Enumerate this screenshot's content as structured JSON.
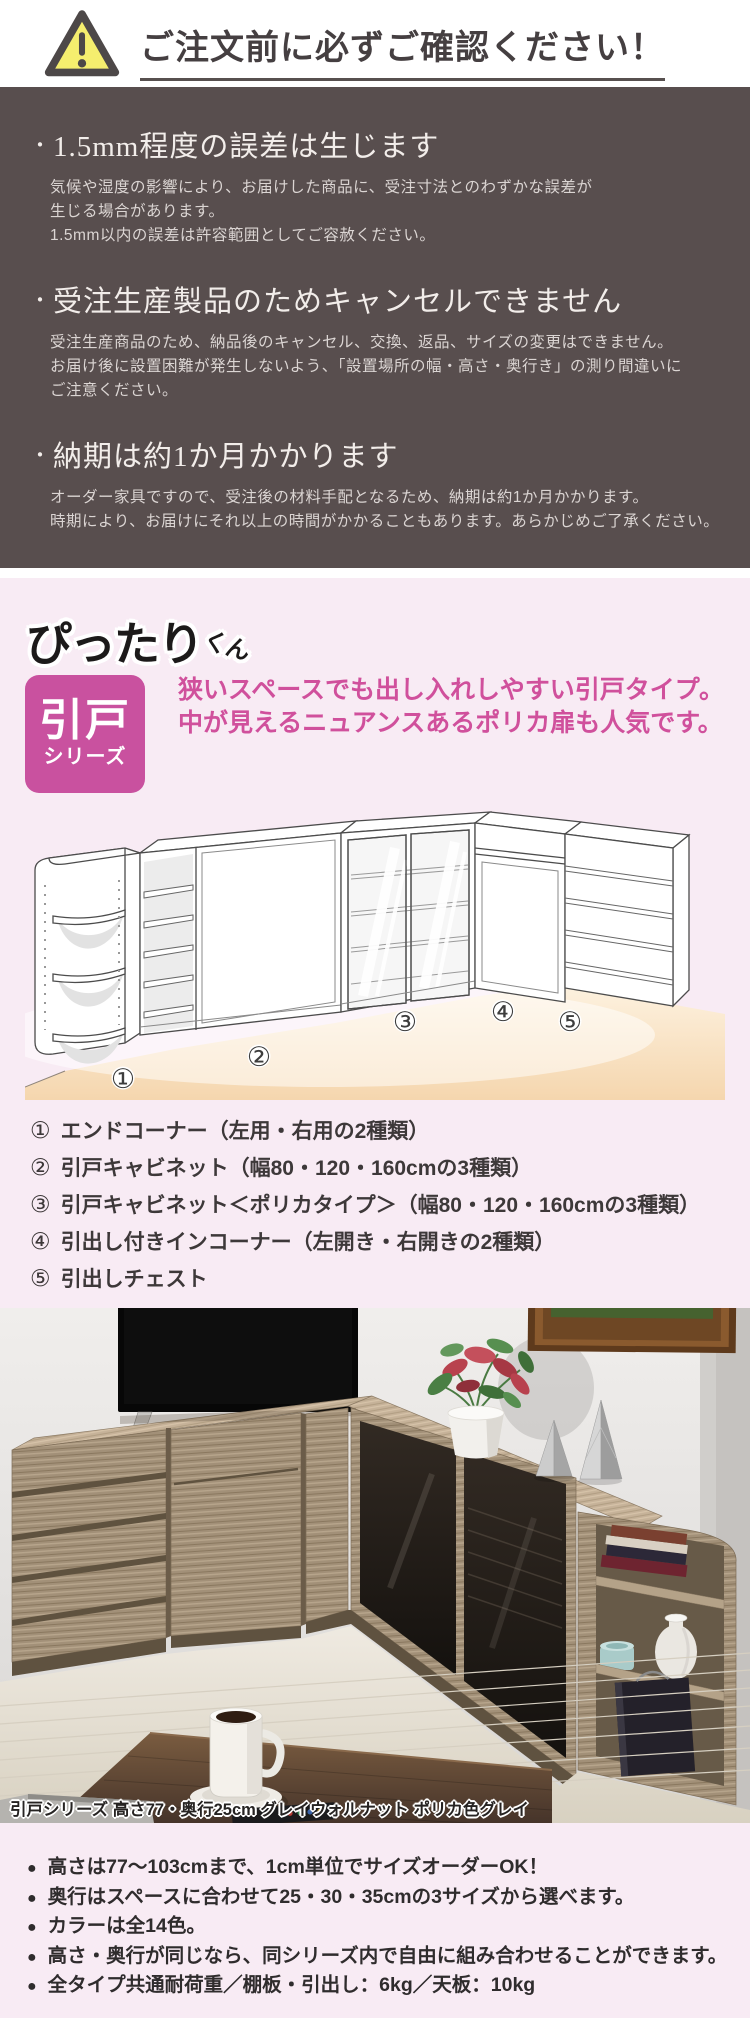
{
  "notice_header": {
    "icon": "warning-triangle-icon",
    "title": "ご注文前に必ずご確認ください！"
  },
  "order_notes": {
    "marker": "・",
    "items": [
      {
        "heading": "1.5mm程度の誤差は生じます",
        "lines": [
          "気候や湿度の影響により、お届けした商品に、受注寸法とのわずかな誤差が",
          "生じる場合があります。",
          "1.5mm以内の誤差は許容範囲としてご容赦ください。"
        ]
      },
      {
        "heading": "受注生産製品のためキャンセルできません",
        "lines": [
          "受注生産商品のため、納品後のキャンセル、交換、返品、サイズの変更はできません。",
          "お届け後に設置困難が発生しないよう、「設置場所の幅・高さ・奥行き」の測り間違いに",
          "ご注意ください。"
        ]
      },
      {
        "heading": "納期は約1か月かかります",
        "lines": [
          "オーダー家具ですので、受注後の材料手配となるため、納期は約1か月かかります。",
          "時期により、お届けにそれ以上の時間がかかることもあります。あらかじめご了承ください。"
        ]
      }
    ]
  },
  "series": {
    "logo_main": "ぴったり",
    "logo_suffix": "くん",
    "badge_line1": "引戸",
    "badge_line2": "シリーズ",
    "description_lines": [
      "狭いスペースでも出し入れしやすい引戸タイプ。",
      "中が見えるニュアンスあるポリカ扉も人気です。"
    ],
    "diagram_numbers": [
      "①",
      "②",
      "③",
      "④",
      "⑤"
    ],
    "legend": [
      {
        "num": "①",
        "text": "エンドコーナー（左用・右用の2種類）"
      },
      {
        "num": "②",
        "text": "引戸キャビネット（幅80・120・160cmの3種類）"
      },
      {
        "num": "③",
        "text": "引戸キャビネット＜ポリカタイプ＞（幅80・120・160cmの3種類）"
      },
      {
        "num": "④",
        "text": "引出し付きインコーナー（左開き・右開きの2種類）"
      },
      {
        "num": "⑤",
        "text": "引出しチェスト"
      }
    ]
  },
  "photo": {
    "caption": "引戸シリーズ 高さ77・奥行25cm グレイウォルナット ポリカ色グレイ"
  },
  "features": {
    "bullet": "●",
    "items": [
      "高さは77〜103cmまで、1cm単位でサイズオーダーOK！",
      "奥行はスペースに合わせて25・30・35cmの3サイズから選べます。",
      "カラーは全14色。",
      "高さ・奥行が同じなら、同シリーズ内で自由に組み合わせることができます。",
      "全タイプ共通耐荷重／棚板・引出し：6kg／天板：10kg"
    ]
  },
  "colors": {
    "dark_section_bg": "#584e4e",
    "pink_bg": "#f8ebf4",
    "accent_pink": "#c9519f",
    "pink_text": "#d0509c",
    "warning_yellow": "#f5ee6e",
    "floor_peach": "#f5d6ae"
  }
}
